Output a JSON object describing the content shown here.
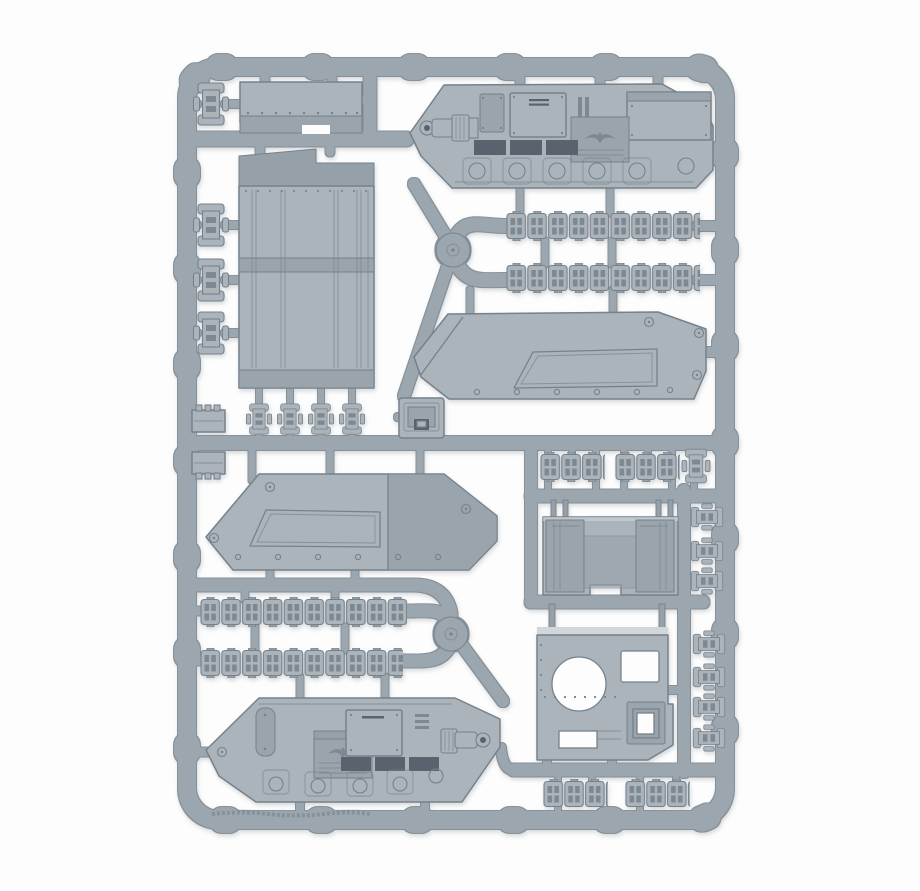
{
  "meta": {
    "type": "photograph",
    "subject": "Grey plastic model-kit sprue with armoured-vehicle (tank) parts photographed on a white background"
  },
  "palette": {
    "bg": "#fdfdfd",
    "plastic": "#abb4bb",
    "plastic-sh": "#9aa4ac",
    "plastic-dk": "#96a0a8",
    "rail": "#9ca6ae",
    "edge": "#76818a",
    "edge2": "#7e8890",
    "recess": "#59646d",
    "recess-lt": "#7e8890",
    "highlight": "#d2d7db",
    "shadow": "#9aa0a6"
  },
  "parts": {
    "sprue": {
      "label": "Plastic model kit sprue"
    },
    "frame": {
      "label": "Sprue frame rails"
    },
    "junction_hub": {
      "label": "Round sprue junction hub"
    },
    "roof_panel": {
      "label": "Flat riveted roof panel"
    },
    "floor_panel": {
      "label": "Ribbed hull floor panel"
    },
    "hull_side_top": {
      "label": "Hull side exterior with weapon and track guard (right side)"
    },
    "hull_side_bottom": {
      "label": "Hull side exterior with weapon and track guard (left side)"
    },
    "inner_panel_right": {
      "label": "Inner hull side panel with rivets (right)"
    },
    "inner_panel_left": {
      "label": "Inner hull side panel with rivets (left)"
    },
    "access_hatch": {
      "label": "Small square access hatch"
    },
    "rear_ramp": {
      "label": "Rear ramp door with hinge pins"
    },
    "turret_plate": {
      "label": "Hull top plate with turret ring opening and hatches"
    },
    "track_run": {
      "label": "Long moulded track run"
    },
    "track_run_short": {
      "label": "Short track run section"
    },
    "track_link": {
      "label": "Individual track link"
    },
    "coupling_block": {
      "label": "Toothed coupling block"
    },
    "emboss": {
      "label": "Faint illegible embossed lettering on bottom rail"
    }
  }
}
